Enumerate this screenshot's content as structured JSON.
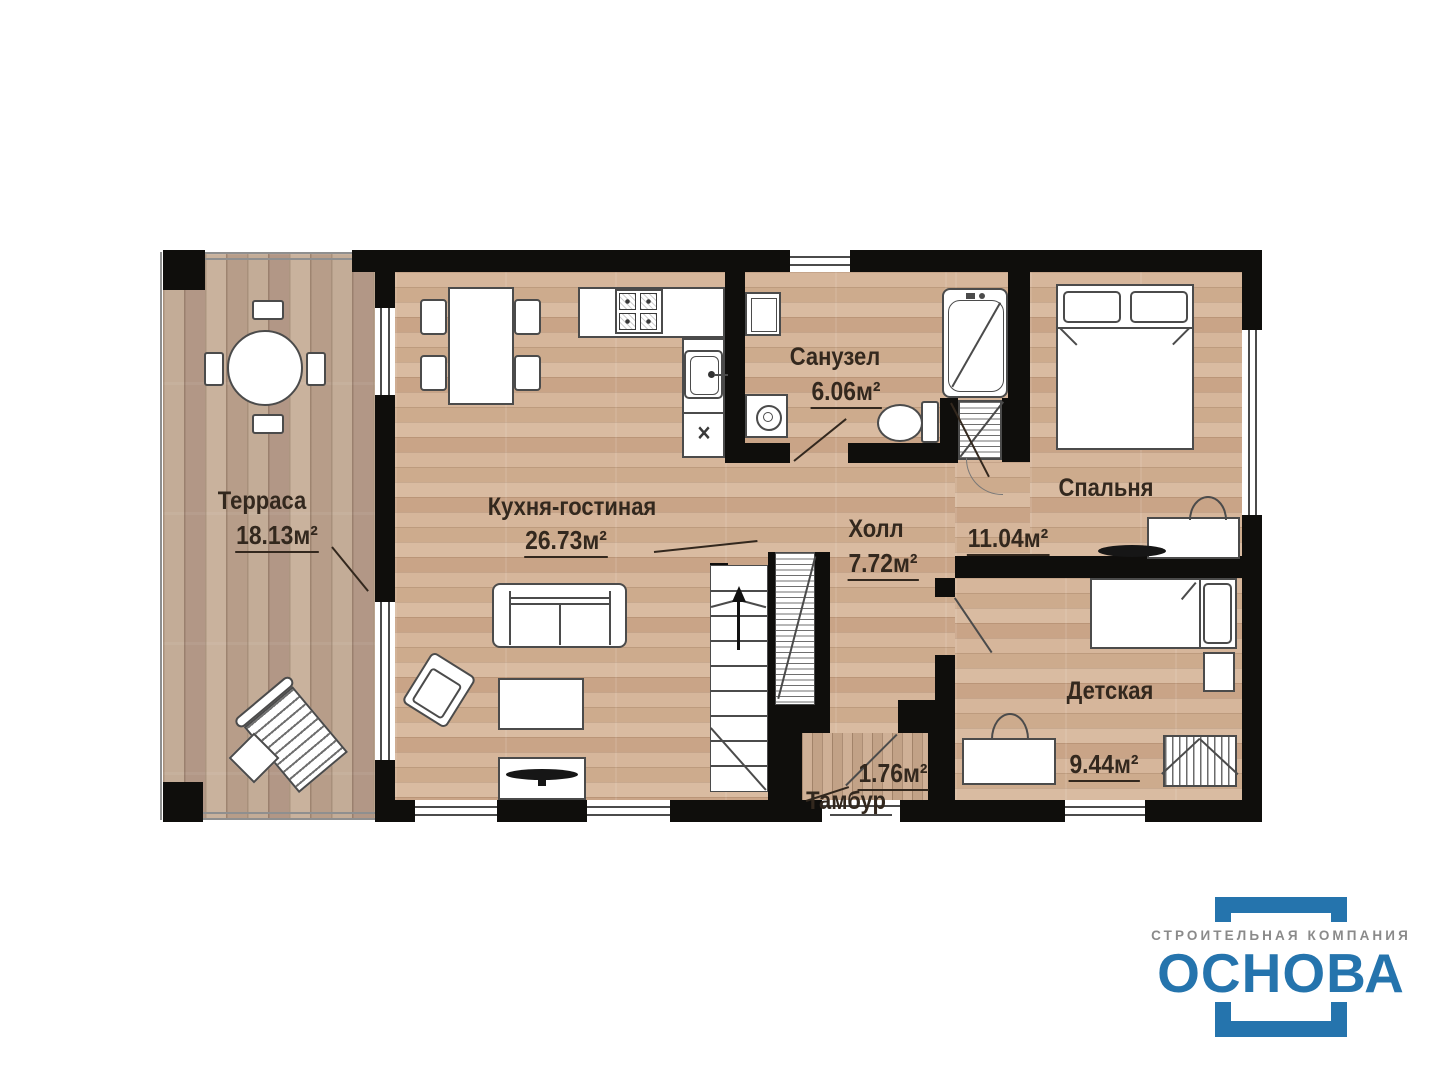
{
  "plan": {
    "rooms": [
      {
        "name": "Терраса",
        "area": "18.13м²"
      },
      {
        "name": "Кухня-гостиная",
        "area": "26.73м²"
      },
      {
        "name": "Санузел",
        "area": "6.06м²"
      },
      {
        "name": "Холл",
        "area": "7.72м²"
      },
      {
        "name": "Спальня",
        "area": "11.04м²"
      },
      {
        "name": "Детская",
        "area": "9.44м²"
      },
      {
        "name": "Тамбур",
        "area": "1.76м²"
      }
    ],
    "cabinet_mark": "✕",
    "colors": {
      "walls": "#0f0e0c",
      "floor_interior": "#d0ae91",
      "floor_terrace": "#bfa893",
      "label_text": "#33281e"
    }
  },
  "logo": {
    "tagline": "СТРОИТЕЛЬНАЯ КОМПАНИЯ",
    "name": "ОСНОВА",
    "colors": {
      "accent_blue": "#2574ad",
      "tagline_gray": "#8a8a8a"
    }
  }
}
